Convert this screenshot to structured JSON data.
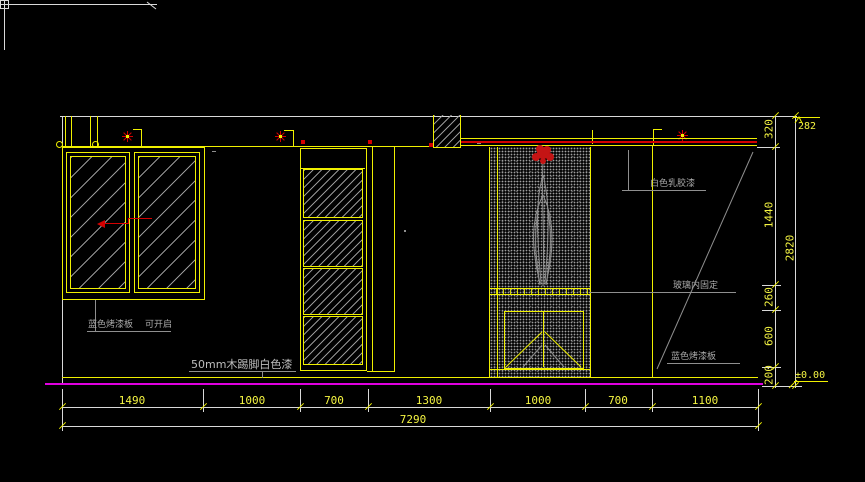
{
  "labels": {
    "window_panel": "蓝色烤漆板",
    "window_openable": "可开启",
    "skirting": "50mm木踢脚白色漆",
    "wall_paint": "白色乳胶漆",
    "glass_fixed": "玻璃内固定",
    "blue_panel": "蓝色烤漆板"
  },
  "dimensions": {
    "bottom": [
      "1490",
      "1000",
      "700",
      "1300",
      "1000",
      "700",
      "1100"
    ],
    "bottom_total": "7290",
    "right": [
      "320",
      "1440",
      "260",
      "600",
      "200"
    ],
    "right_total": "2820",
    "ceiling_level": "282",
    "floor_level": "±0.00"
  },
  "colors": {
    "background": "#000000",
    "line_yellow": "#f0f000",
    "line_white": "#d9d9d9",
    "line_gray": "#8f8f8f",
    "line_red": "#d40000",
    "line_magenta": "#e000e0",
    "dim_text": "#f5f542"
  }
}
